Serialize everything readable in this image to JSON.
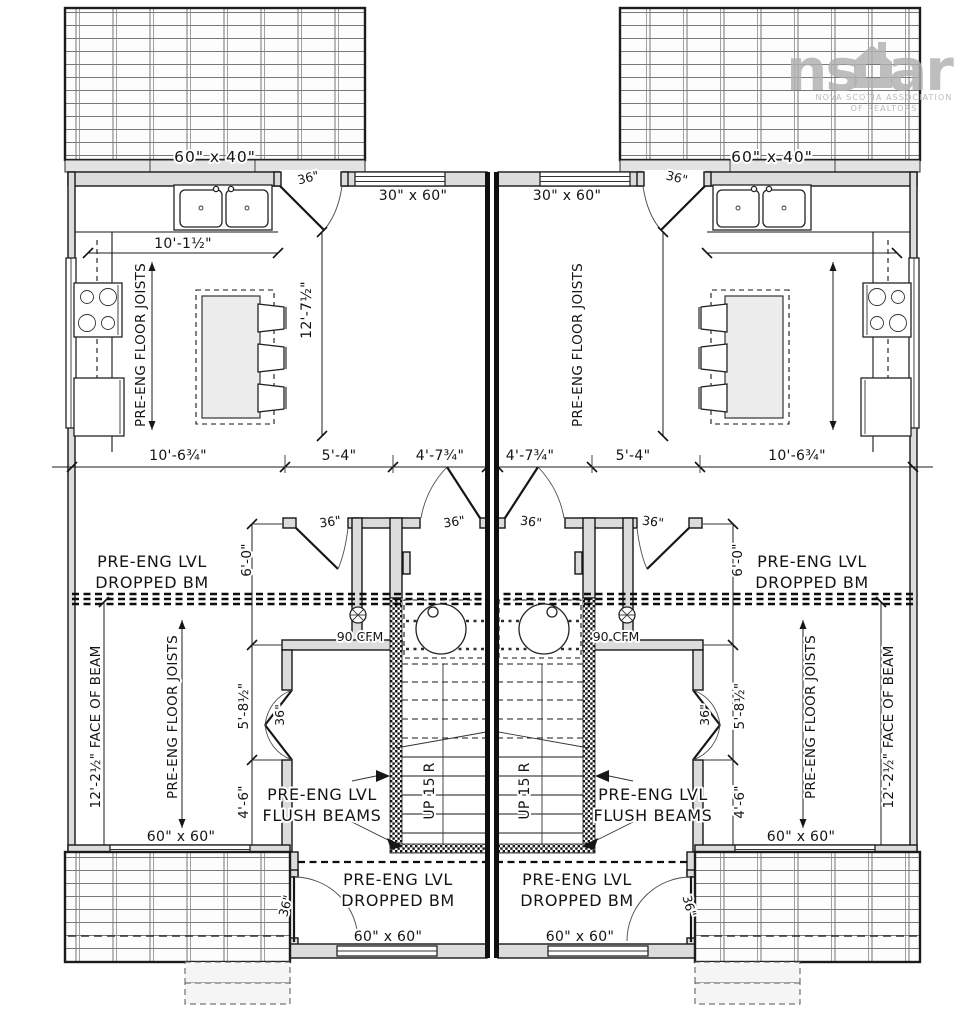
{
  "watermark": {
    "brand_left": "ns",
    "brand_right": "ar",
    "subtitle_line1": "NOVA SCOTIA ASSOCIATION",
    "subtitle_line2": "OF REALTORS"
  },
  "labels": {
    "deck_top": "60\" x 40\"",
    "window_rear": "60\" x 60\"",
    "window_front": "30\" x 60\"",
    "door": "36\"",
    "dim_kitchen_w": "10'-1½\"",
    "dim_kitchen_d": "12'-7½\"",
    "dim_10_6": "10'-6¾\"",
    "dim_5_4": "5'-4\"",
    "dim_4_7": "4'-7¾\"",
    "dim_6_0": "6'-0\"",
    "dim_5_8": "5'-8½\"",
    "dim_4_6": "4'-6\"",
    "face_of_beam": "12'-2½\" FACE OF BEAM",
    "fan": "90 CFM",
    "stairs_up": "UP 15 R",
    "preeng_lvl": "PRE-ENG LVL",
    "dropped_bm": "DROPPED BM",
    "flush_beams": "FLUSH BEAMS",
    "floor_joists": "PRE-ENG FLOOR JOISTS"
  },
  "colors": {
    "line": "#161616",
    "wall_fill": "#dcdcdc",
    "watermark_gray": "#b0b0b0",
    "paper": "#ffffff"
  }
}
